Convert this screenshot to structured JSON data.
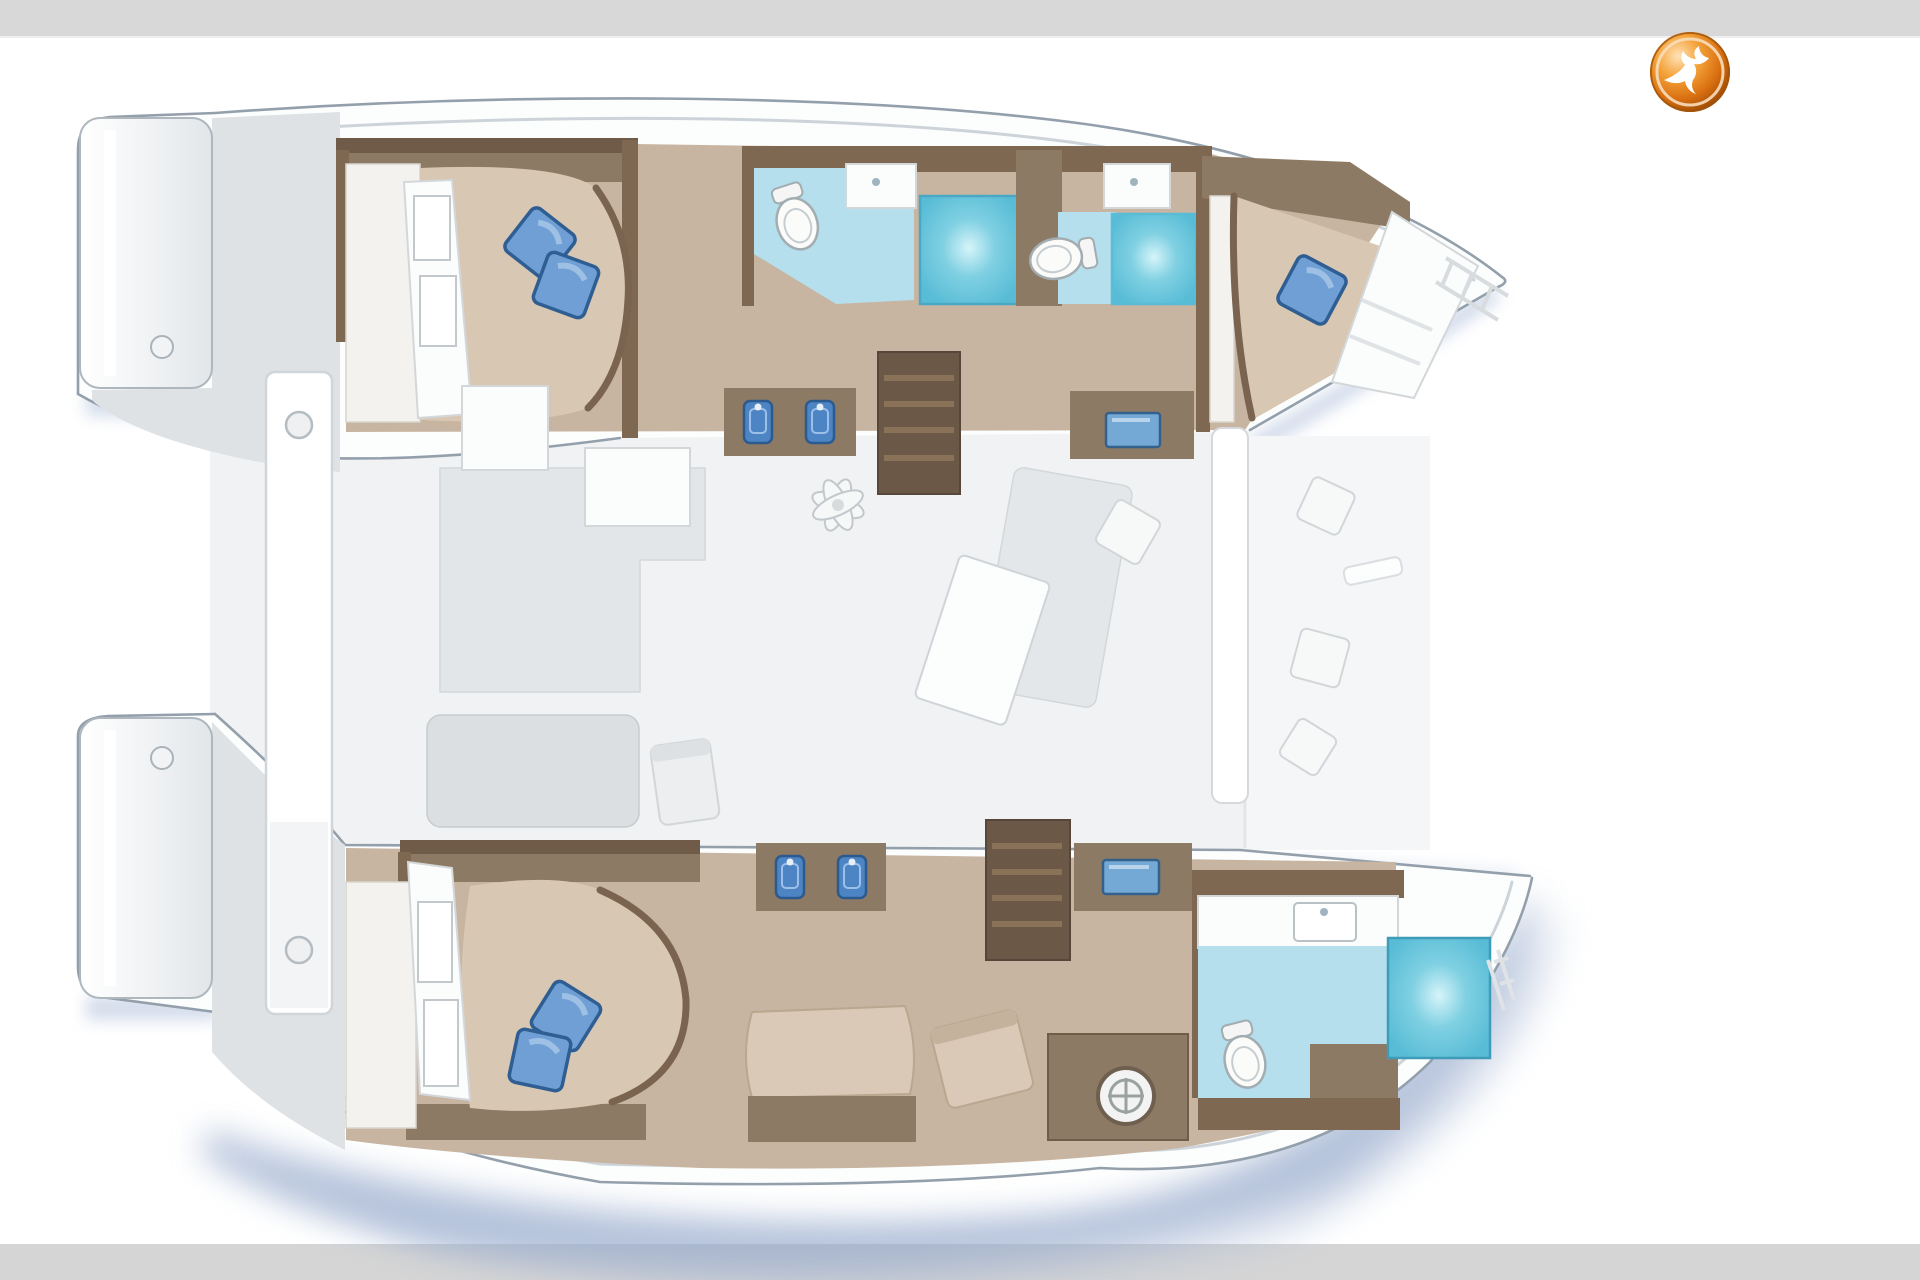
{
  "meta": {
    "title": "Catamaran yacht interior layout plan, top view",
    "description": "Floor plan of a sailing catamaran: two hulls with cabins and bathrooms, central saloon with galley and stairs, aft cockpit, forward cockpit, broker logo top right. No visible text labels in the image."
  },
  "logo": {
    "icon": "bird-logo-icon",
    "shape": "glossy orange sphere with white seagull silhouette",
    "orange": "#e0791c",
    "orange_dark": "#9c4a06",
    "orange_light": "#ffe2b8",
    "bird_color": "#ffffff"
  },
  "palette": {
    "top_bar": "#d8d8d8",
    "bottom_bar": "#d5d5d5",
    "page_bg": "#ffffff",
    "hull_fill": "#fcfdfd",
    "hull_outline": "#93a0ac",
    "deck_grey": "#dfe2e5",
    "saloon_floor": "#f0f2f3",
    "cabin_floor": "#c7b5a1",
    "wall_brown": "#7e6852",
    "cabinet_brown": "#8d7a64",
    "stairs_brown": "#6b5847",
    "mattress": "#d8c7b2",
    "pillow_blue": "#6f9fd4",
    "bath_floor_blue": "#b5dfec",
    "shower_teal": "#58bcd6",
    "sink_blue": "#4d84c4",
    "screen_blue": "#74a9d6",
    "shadow_blue": "#8aa0c6"
  },
  "regions": [
    {
      "name": "port-aft-cabin",
      "features": [
        "double-bed",
        "two-blue-pillows",
        "hull-windows"
      ]
    },
    {
      "name": "port-aft-head",
      "features": [
        "toilet",
        "sink",
        "shower"
      ]
    },
    {
      "name": "port-forward-head",
      "features": [
        "toilet",
        "sink",
        "shower"
      ]
    },
    {
      "name": "port-forward-cabin",
      "features": [
        "double-bed",
        "one-blue-pillow",
        "wardrobe"
      ]
    },
    {
      "name": "port-companionway-stairs",
      "features": [
        "4-steps"
      ]
    },
    {
      "name": "saloon-galley",
      "features": [
        "galley-counter",
        "twin-sinks",
        "nav-screen",
        "dining-table",
        "fan"
      ]
    },
    {
      "name": "aft-cockpit",
      "features": [
        "bench",
        "column",
        "stern-platforms"
      ]
    },
    {
      "name": "forward-cockpit",
      "features": [
        "bench",
        "cushions"
      ]
    },
    {
      "name": "starboard-aft-cabin",
      "features": [
        "double-bed",
        "two-blue-pillows",
        "hull-windows"
      ]
    },
    {
      "name": "starboard-lounge",
      "features": [
        "chaise",
        "chair",
        "twin-sinks",
        "nav-screen",
        "wheel-cabinet"
      ]
    },
    {
      "name": "starboard-companionway-stairs",
      "features": [
        "4-steps"
      ]
    },
    {
      "name": "starboard-forward-head",
      "features": [
        "toilet",
        "sink",
        "shower"
      ]
    }
  ]
}
